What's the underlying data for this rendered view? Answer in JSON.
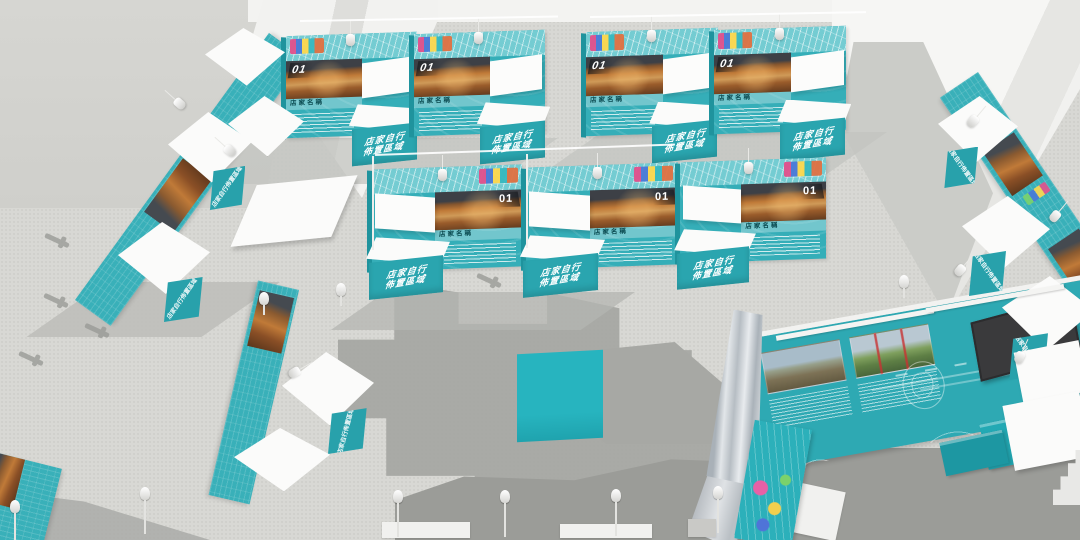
{
  "booth": {
    "number": "01",
    "name_label": "店家名稱",
    "counter_line1": "店家自行",
    "counter_line2": "佈置區域",
    "counter_label": "店家自行佈置區域"
  },
  "colors": {
    "teal": "#35aeb8",
    "teal_dark": "#1f939d",
    "teal_band": "#74ccd2",
    "counter_teal": "#2aa5af",
    "floor": "#d8d8d4",
    "wall_gray": "#d2d2cf",
    "wall_white": "#f3f3f1",
    "shadow": "#a4a5a1",
    "screen": "#3a3a3c"
  }
}
